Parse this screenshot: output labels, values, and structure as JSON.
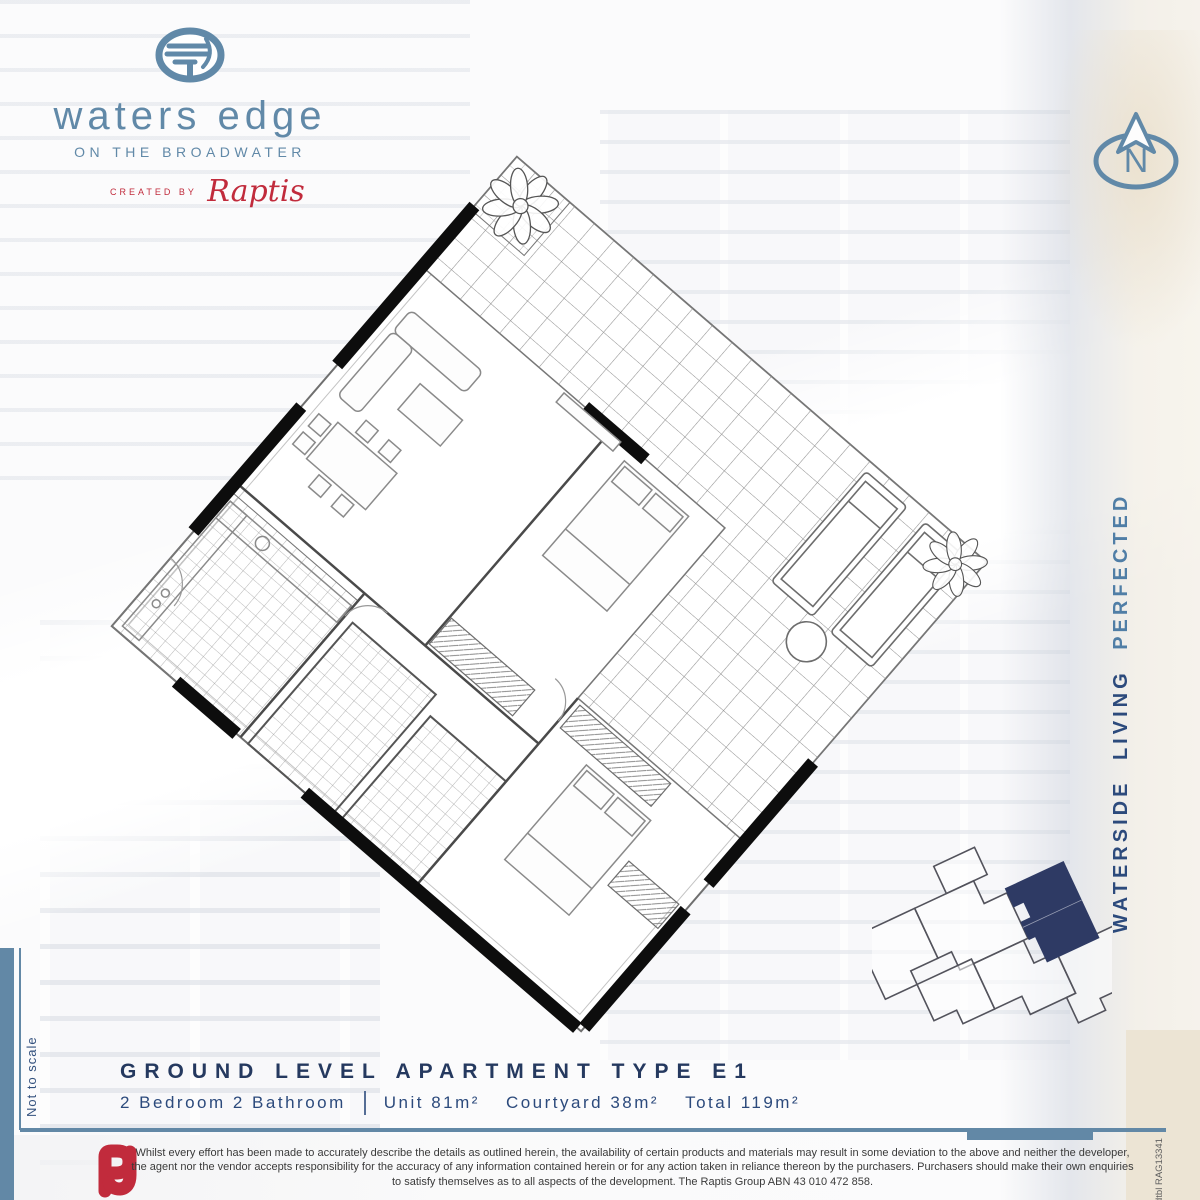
{
  "colors": {
    "steel": "#6189a8",
    "navy": "#25395f",
    "navyText": "#2c4a7c",
    "accent": "#507ea6",
    "red": "#c12b3c",
    "keyplan": "#2e3a64",
    "rule": "#6288a6",
    "ink": "#3a3a3a",
    "print": "#5f5f5f"
  },
  "logo": {
    "brand": "waters edge",
    "tagline": "ON THE BROADWATER",
    "created_by": "CREATED BY",
    "creator": "Raptis"
  },
  "compass": {
    "letter": "N"
  },
  "side": {
    "main": "WATERSIDE LIVING ",
    "accent": "PERFECTED"
  },
  "footer": {
    "title": "GROUND LEVEL APARTMENT TYPE E1",
    "rooms": "2 Bedroom 2 Bathroom",
    "specs": [
      "Unit 81m²",
      "Courtyard 38m²",
      "Total 119m²"
    ]
  },
  "notes": {
    "not_to_scale": "Not to scale",
    "print_code": "dtbl RAG13341"
  },
  "disclaimer": {
    "text": "Whilst every effort has been made to accurately describe the details as outlined herein, the availability of certain products and materials may result in some deviation to the above and neither the developer, the agent nor the vendor accepts responsibility for the accuracy of any information contained herein or for any action taken in reliance thereon by the purchasers. Purchasers should make their own enquiries to satisfy themselves as to all aspects of the development. The Raptis Group ABN 43 010 472 858."
  }
}
